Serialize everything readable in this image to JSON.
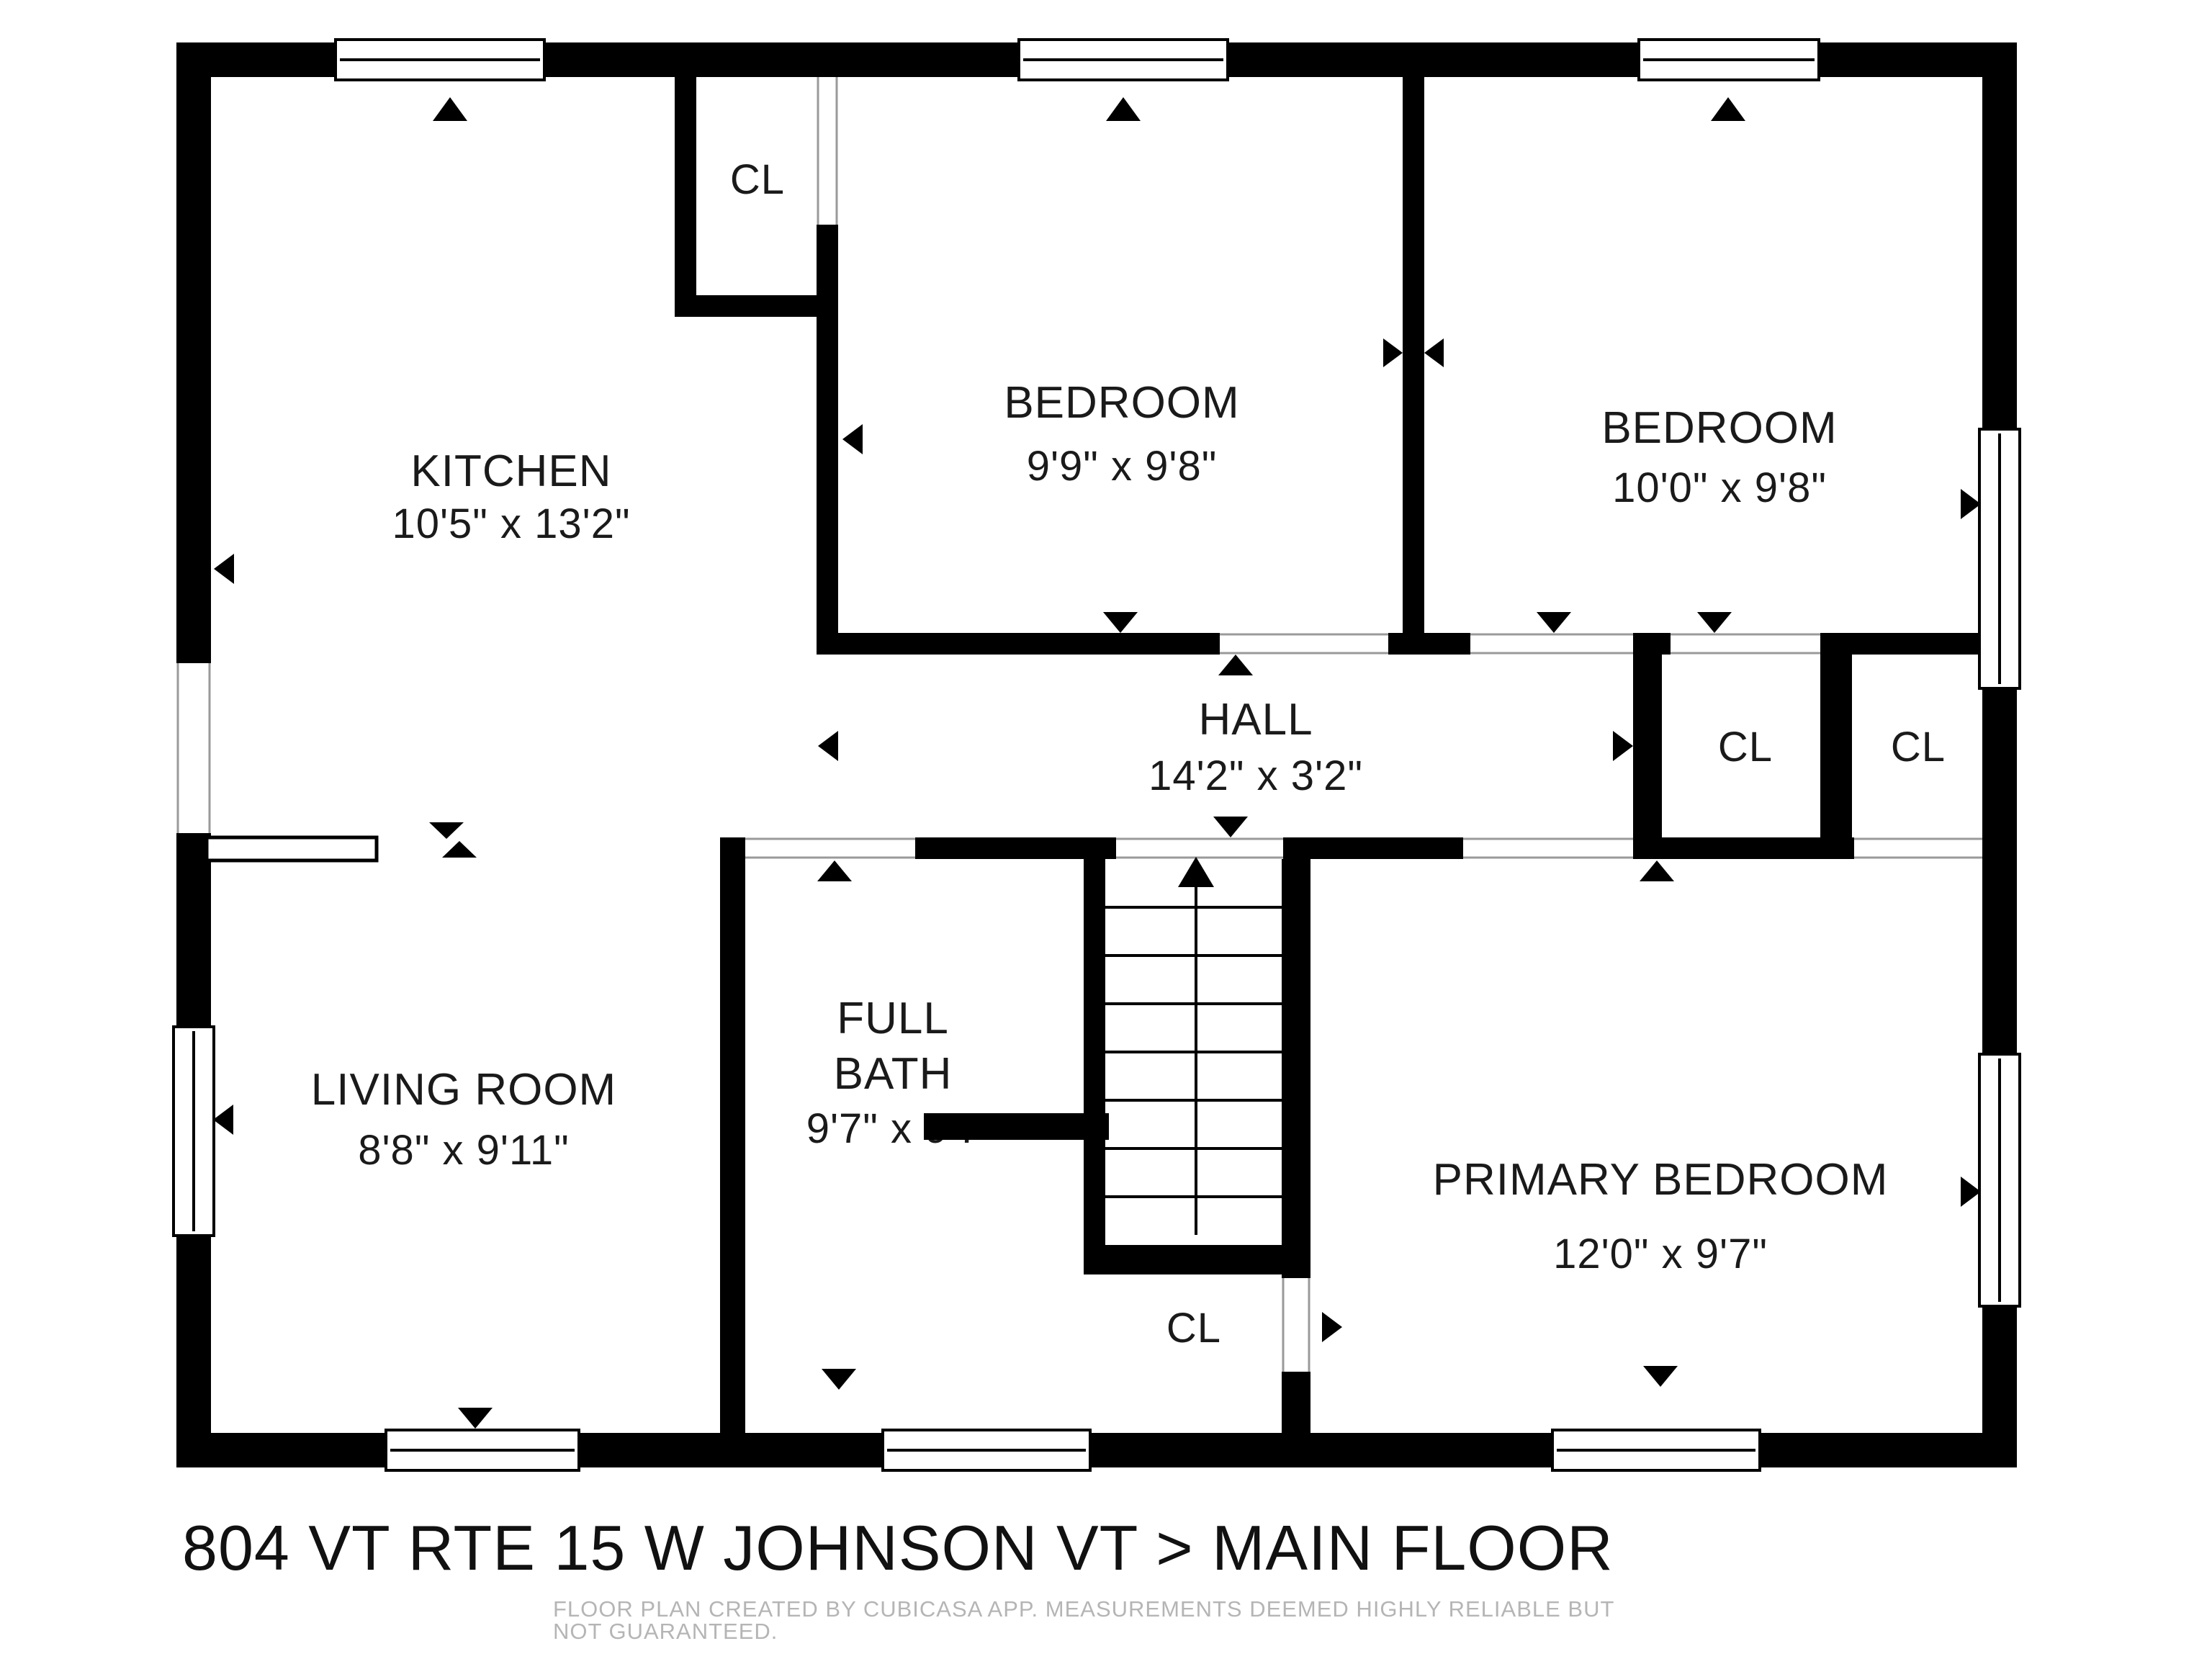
{
  "title": "804 VT RTE 15 W JOHNSON VT > MAIN FLOOR",
  "footer_disclaimer": "FLOOR PLAN CREATED BY CUBICASA APP. MEASUREMENTS DEEMED HIGHLY RELIABLE BUT NOT GUARANTEED.",
  "rooms": {
    "kitchen": {
      "name": "KITCHEN",
      "dims": "10'5\" x 13'2\""
    },
    "bedroom_top": {
      "name": "BEDROOM",
      "dims": "9'9\" x 9'8\""
    },
    "bedroom_right": {
      "name": "BEDROOM",
      "dims": "10'0\" x 9'8\""
    },
    "hall": {
      "name": "HALL",
      "dims": "14'2\" x 3'2\""
    },
    "living_room": {
      "name": "LIVING ROOM",
      "dims": "8'8\" x 9'11\""
    },
    "full_bath": {
      "name_line1": "FULL",
      "name_line2": "BATH",
      "dims": "9'7\" x 9'7\""
    },
    "primary_bedroom": {
      "name": "PRIMARY BEDROOM",
      "dims": "12'0\" x 9'7\""
    }
  },
  "closets": {
    "top_closet": "CL",
    "hall_closet_left": "CL",
    "hall_closet_right": "CL",
    "under_stairs_closet": "CL"
  },
  "symbols": {
    "stairs_direction": "up"
  },
  "colors": {
    "walls": "#000000",
    "background": "#ffffff",
    "room_text": "#1a1a1a",
    "footer_text": "#b5b5b5"
  }
}
